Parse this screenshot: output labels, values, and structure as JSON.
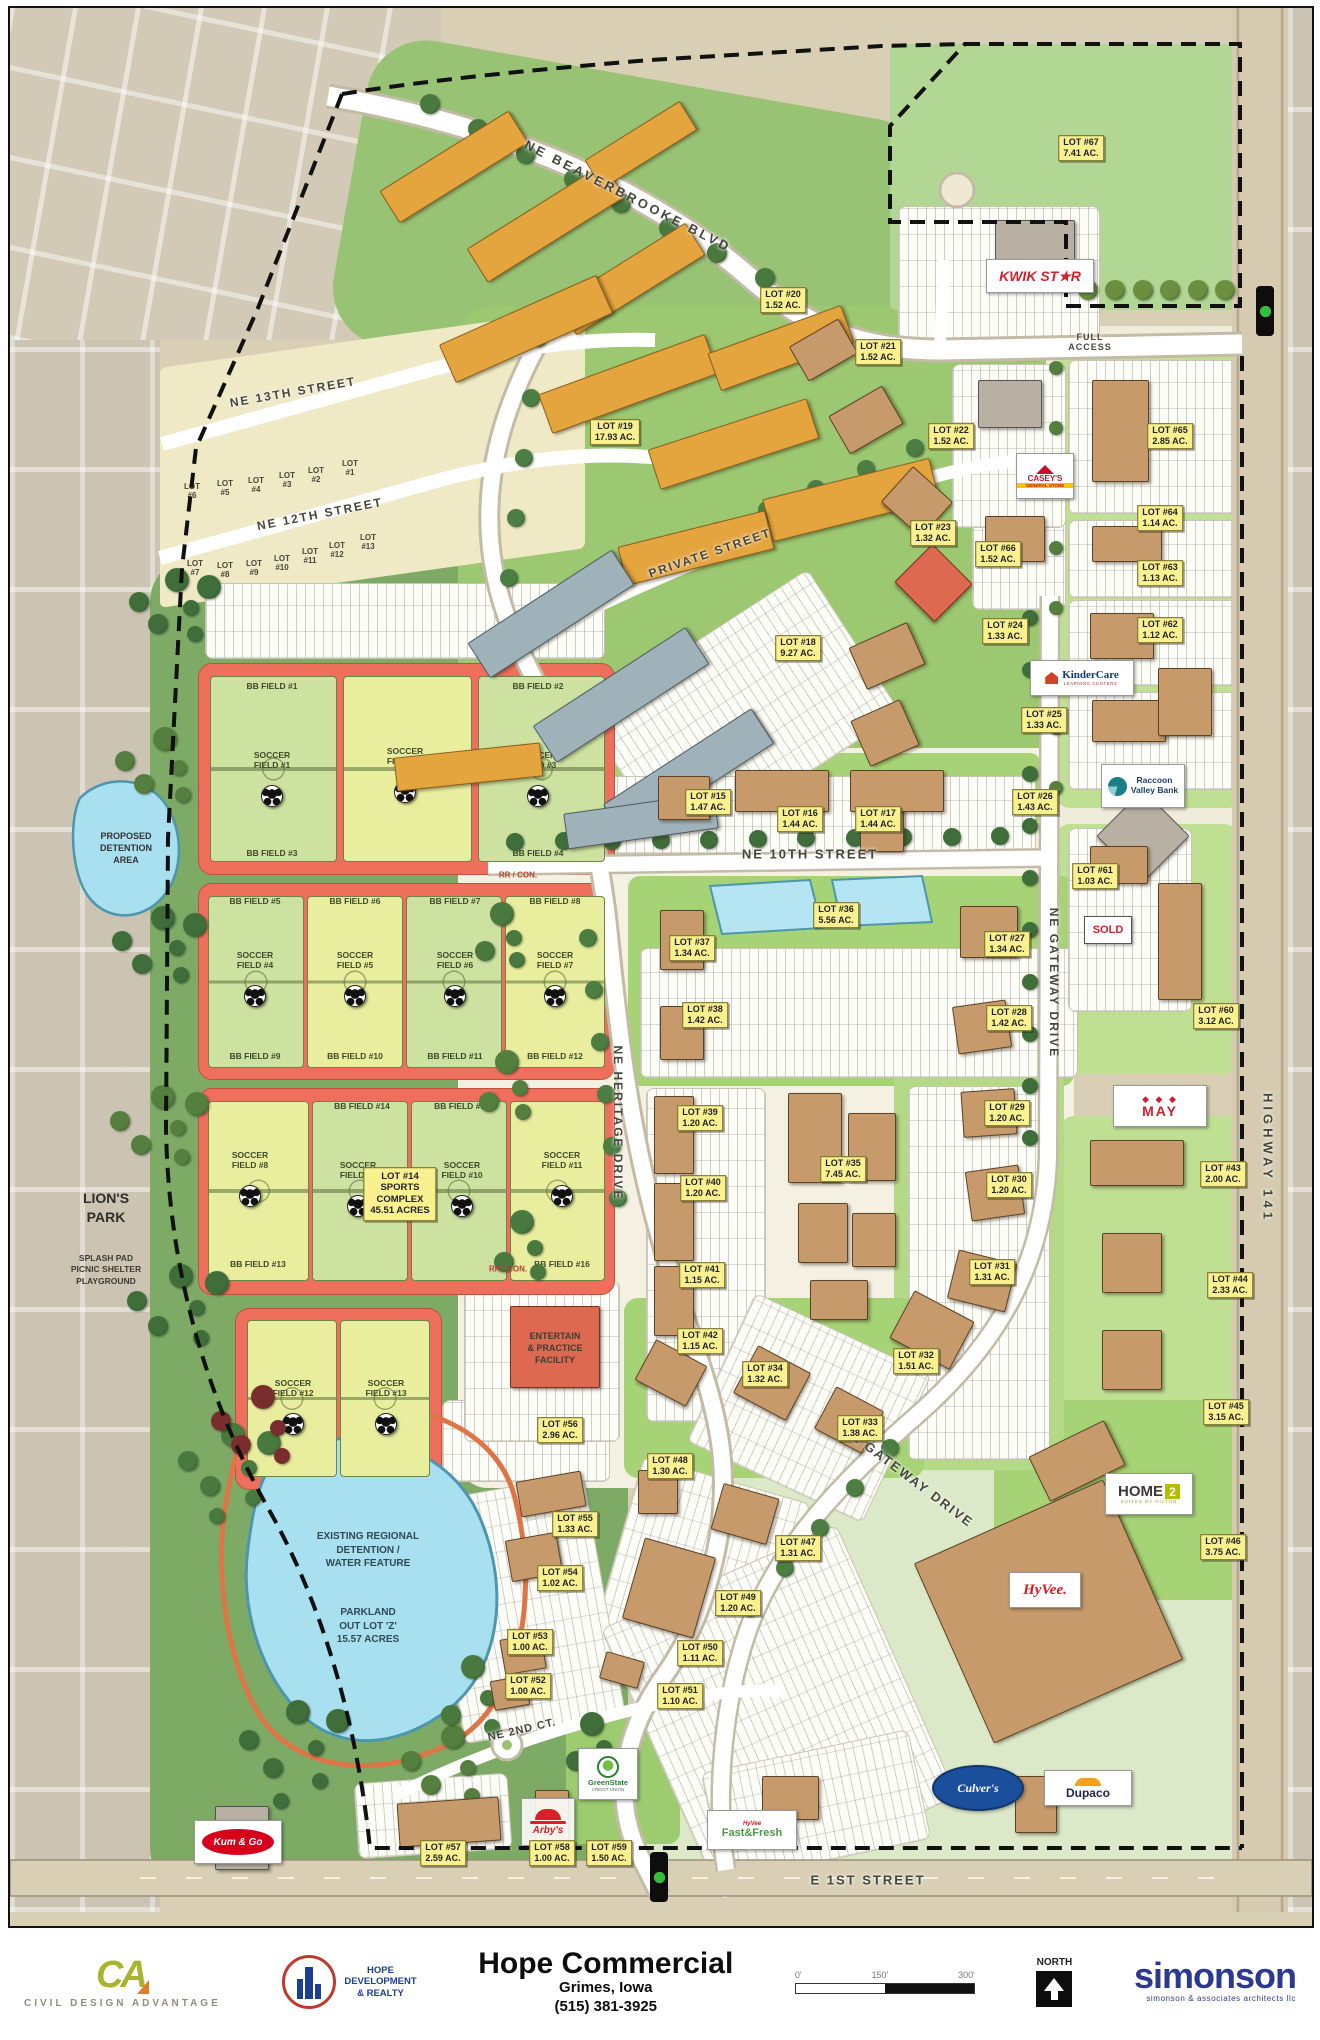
{
  "map_title": "Hope Commercial Site Plan",
  "streets": [
    {
      "id": "beaverbrooke",
      "label": "NE BEAVERBROOKE BLVD"
    },
    {
      "id": "ne13",
      "label": "NE 13TH STREET"
    },
    {
      "id": "ne12",
      "label": "NE 12TH STREET"
    },
    {
      "id": "private",
      "label": "PRIVATE STREET"
    },
    {
      "id": "ne10",
      "label": "NE 10TH STREET"
    },
    {
      "id": "heritage",
      "label": "NE HERITAGE DRIVE"
    },
    {
      "id": "gateway_n",
      "label": "NE GATEWAY DRIVE"
    },
    {
      "id": "gateway_s",
      "label": "NE GATEWAY DRIVE"
    },
    {
      "id": "ne2ct",
      "label": "NE 2ND CT."
    },
    {
      "id": "e1st",
      "label": "E 1ST STREET"
    },
    {
      "id": "hwy141",
      "label": "HIGHWAY 141"
    },
    {
      "id": "full_access",
      "label": "FULL\nACCESS"
    }
  ],
  "misc_labels": [
    {
      "id": "proposed_detention",
      "text": "PROPOSED\nDETENTION\nAREA"
    },
    {
      "id": "lions_park",
      "text": "LION'S\nPARK"
    },
    {
      "id": "lions_amenities",
      "text": "SPLASH PAD\nPICNIC SHELTER\nPLAYGROUND"
    },
    {
      "id": "regional_detention",
      "text": "EXISTING REGIONAL\nDETENTION /\nWATER FEATURE"
    },
    {
      "id": "parkland",
      "text": "PARKLAND\nOUT LOT 'Z'\n15.57 ACRES"
    },
    {
      "id": "entertain",
      "text": "ENTERTAIN\n& PRACTICE\nFACILITY"
    },
    {
      "id": "rr_con_1",
      "text": "RR / CON."
    },
    {
      "id": "rr_con_2",
      "text": "RR / CON."
    }
  ],
  "lots": [
    {
      "label": "LOT #15",
      "area": "1.47 AC."
    },
    {
      "label": "LOT #16",
      "area": "1.44 AC."
    },
    {
      "label": "LOT #17",
      "area": "1.44 AC."
    },
    {
      "label": "LOT #18",
      "area": "9.27 AC."
    },
    {
      "label": "LOT #19",
      "area": "17.93 AC."
    },
    {
      "label": "LOT #20",
      "area": "1.52 AC."
    },
    {
      "label": "LOT #21",
      "area": "1.52 AC."
    },
    {
      "label": "LOT #22",
      "area": "1.52 AC."
    },
    {
      "label": "LOT #23",
      "area": "1.32 AC."
    },
    {
      "label": "LOT #24",
      "area": "1.33 AC."
    },
    {
      "label": "LOT #25",
      "area": "1.33 AC."
    },
    {
      "label": "LOT #26",
      "area": "1.43 AC."
    },
    {
      "label": "LOT #27",
      "area": "1.34 AC."
    },
    {
      "label": "LOT #28",
      "area": "1.42 AC."
    },
    {
      "label": "LOT #29",
      "area": "1.20 AC."
    },
    {
      "label": "LOT #30",
      "area": "1.20 AC."
    },
    {
      "label": "LOT #31",
      "area": "1.31 AC."
    },
    {
      "label": "LOT #32",
      "area": "1.51 AC."
    },
    {
      "label": "LOT #33",
      "area": "1.38 AC."
    },
    {
      "label": "LOT #34",
      "area": "1.32 AC."
    },
    {
      "label": "LOT #35",
      "area": "7.45 AC."
    },
    {
      "label": "LOT #36",
      "area": "5.56 AC."
    },
    {
      "label": "LOT #37",
      "area": "1.34 AC."
    },
    {
      "label": "LOT #38",
      "area": "1.42 AC."
    },
    {
      "label": "LOT #39",
      "area": "1.20 AC."
    },
    {
      "label": "LOT #40",
      "area": "1.20 AC."
    },
    {
      "label": "LOT #41",
      "area": "1.15 AC."
    },
    {
      "label": "LOT #42",
      "area": "1.15 AC."
    },
    {
      "label": "LOT #43",
      "area": "2.00 AC."
    },
    {
      "label": "LOT #44",
      "area": "2.33 AC."
    },
    {
      "label": "LOT #45",
      "area": "3.15 AC."
    },
    {
      "label": "LOT #46",
      "area": "3.75 AC."
    },
    {
      "label": "LOT #47",
      "area": "1.31 AC."
    },
    {
      "label": "LOT #48",
      "area": "1.30 AC."
    },
    {
      "label": "LOT #49",
      "area": "1.20 AC."
    },
    {
      "label": "LOT #50",
      "area": "1.11 AC."
    },
    {
      "label": "LOT #51",
      "area": "1.10 AC."
    },
    {
      "label": "LOT #52",
      "area": "1.00 AC."
    },
    {
      "label": "LOT #53",
      "area": "1.00 AC."
    },
    {
      "label": "LOT #54",
      "area": "1.02 AC."
    },
    {
      "label": "LOT #55",
      "area": "1.33 AC."
    },
    {
      "label": "LOT #56",
      "area": "2.96 AC."
    },
    {
      "label": "LOT #57",
      "area": "2.59 AC."
    },
    {
      "label": "LOT #58",
      "area": "1.00 AC."
    },
    {
      "label": "LOT #59",
      "area": "1.50 AC."
    },
    {
      "label": "LOT #60",
      "area": "3.12 AC."
    },
    {
      "label": "LOT #61",
      "area": "1.03 AC."
    },
    {
      "label": "LOT #62",
      "area": "1.12 AC."
    },
    {
      "label": "LOT #63",
      "area": "1.13 AC."
    },
    {
      "label": "LOT #64",
      "area": "1.14 AC."
    },
    {
      "label": "LOT #65",
      "area": "2.85 AC."
    },
    {
      "label": "LOT #66",
      "area": "1.52 AC."
    },
    {
      "label": "LOT #67",
      "area": "7.41 AC."
    }
  ],
  "small_lots": [
    "LOT #1",
    "LOT #2",
    "LOT #3",
    "LOT #4",
    "LOT #5",
    "LOT #6",
    "LOT #7",
    "LOT #8",
    "LOT #9",
    "LOT #10",
    "LOT #11",
    "LOT #12",
    "LOT #13"
  ],
  "sports": {
    "bb_fields": [
      "BB FIELD #1",
      "BB FIELD #2",
      "BB FIELD #3",
      "BB FIELD #4",
      "BB FIELD #5",
      "BB FIELD #6",
      "BB FIELD #7",
      "BB FIELD #8",
      "BB FIELD #9",
      "BB FIELD #10",
      "BB FIELD #11",
      "BB FIELD #12",
      "BB FIELD #13",
      "BB FIELD #14",
      "BB FIELD #15",
      "BB FIELD #16"
    ],
    "soccer_fields": [
      "SOCCER\nFIELD #1",
      "SOCCER\nFIELD #2",
      "SOCCER\nFIELD #3",
      "SOCCER\nFIELD #4",
      "SOCCER\nFIELD #5",
      "SOCCER\nFIELD #6",
      "SOCCER\nFIELD #7",
      "SOCCER\nFIELD #8",
      "SOCCER\nFIELD #9",
      "SOCCER\nFIELD #10",
      "SOCCER\nFIELD #11",
      "SOCCER\nFIELD #12",
      "SOCCER\nFIELD #13"
    ],
    "lot14_tag": "LOT #14\nSPORTS\nCOMPLEX\n45.51 ACRES"
  },
  "logos": {
    "kwik_star": "KWIK ST★R",
    "caseys": "CASEY'S",
    "caseys_sub": "GENERAL STORE",
    "kindercare": "KinderCare",
    "kindercare_sub": "LEARNING CENTERS",
    "raccoon": "Raccoon\nValley Bank",
    "sold": "SOLD",
    "earl_may": "MAY",
    "earl_may_diamonds": "◆ ◆ ◆",
    "home2": "HOME",
    "home2_number": "2",
    "home2_sub": "SUITES BY HILTON",
    "hyvee": "HyVee.",
    "culvers": "Culver's",
    "dupaco": "Dupaco",
    "fastfresh_brand": "HyVee",
    "fastfresh": "Fast&Fresh",
    "kum_go": "Kum & Go",
    "arbys": "Arby's",
    "greenstate": "GreenState",
    "greenstate_sub": "CREDIT UNION"
  },
  "title_block": {
    "project_title": "Hope Commercial",
    "project_city": "Grimes, Iowa",
    "project_phone": "(515) 381-3925",
    "cda_mark": "CA",
    "cda_name": "CIVIL DESIGN ADVANTAGE",
    "hope_name": "HOPE\nDEVELOPMENT\n& REALTY",
    "north_label": "NORTH",
    "scale_ticks": [
      "0'",
      "150'",
      "300'"
    ],
    "simonson": "simonson",
    "simonson_sub": "simonson & associates architects llc"
  }
}
